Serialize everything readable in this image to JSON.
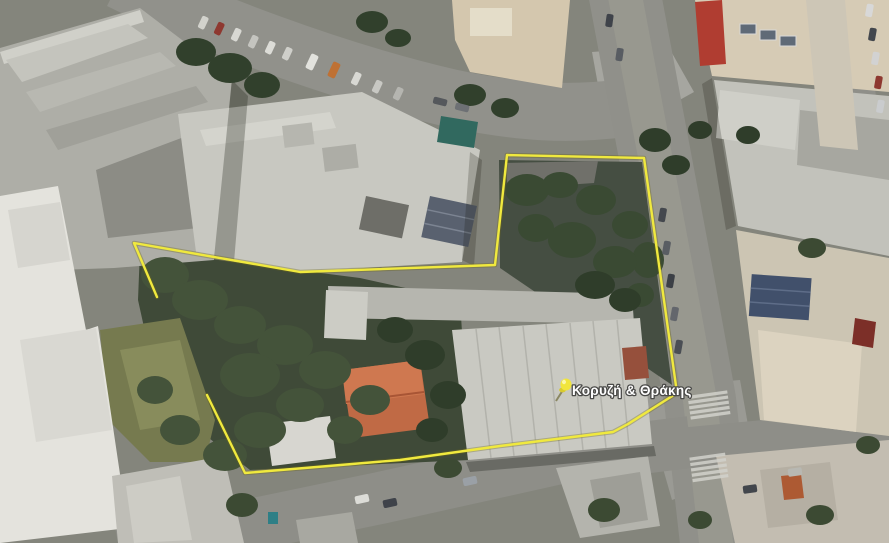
{
  "map": {
    "view_type": "satellite aerial view",
    "location_label": {
      "text": "Κορυζή & Θράκης",
      "color": "#ffffff",
      "outline_color": "#4a4a48"
    },
    "pin": {
      "icon": "yellow-pushpin",
      "head_color": "#f1e53c",
      "needle_color": "#8a8762"
    },
    "boundary": {
      "color": "#f0e93e",
      "halo_color": "#6d6716",
      "points": "157,297 134,243 300,272 495,265 507,155 644,158 677,393 628,424 613,432 500,446 400,460 245,473 207,395"
    },
    "palette": {
      "ground": "#84857c",
      "road": "#90908a"
    }
  }
}
